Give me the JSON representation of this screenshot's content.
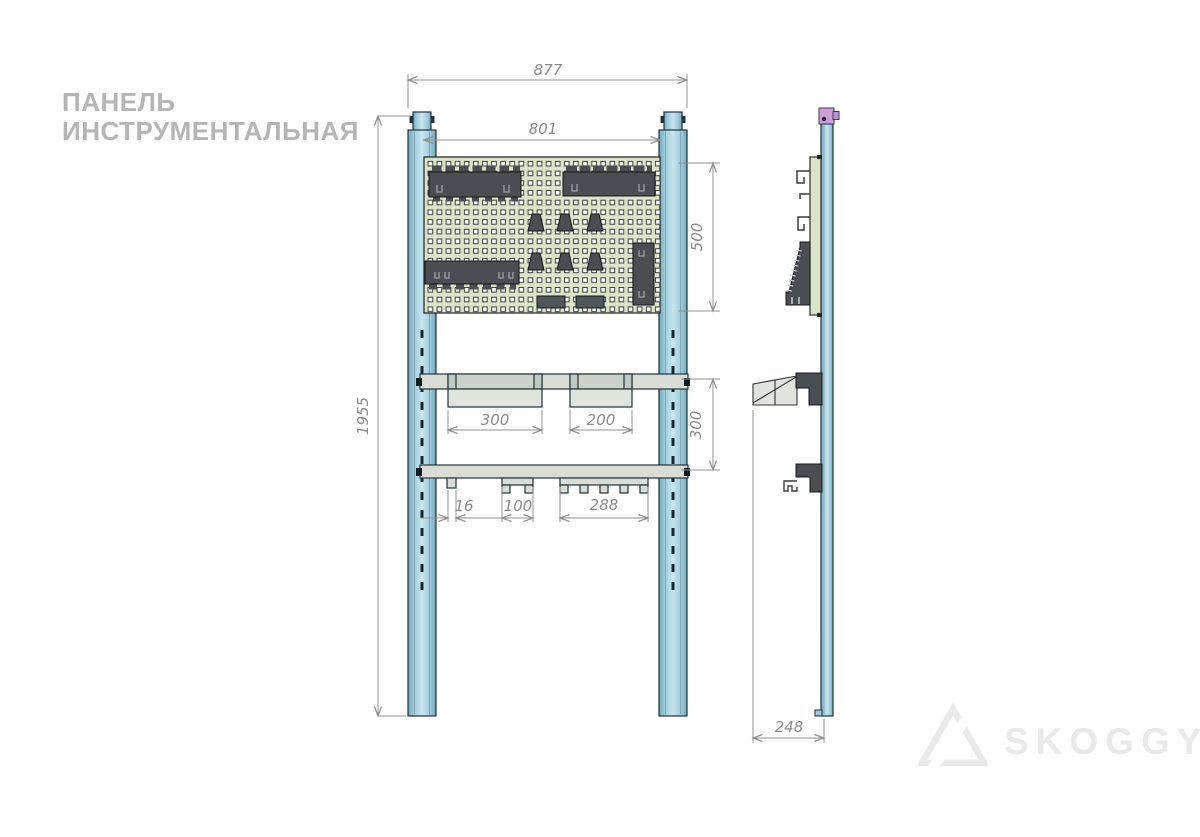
{
  "title": {
    "line1": "ПАНЕЛЬ",
    "line2": "ИНСТРУМЕНТАЛЬНАЯ"
  },
  "brand": {
    "name": "SKOGGY"
  },
  "drawing": {
    "type": "technical drawing — tool panel, front view and side view",
    "views": {
      "front": {
        "dims": {
          "overall_width": "877",
          "panel_width": "801",
          "panel_height": "500",
          "overall_height": "1955",
          "bin_large_width": "300",
          "bin_small_width": "200",
          "rail_spacing": "300",
          "hook_width": "16",
          "bracket_medium_width": "100",
          "bracket_wide_width": "288"
        }
      },
      "side": {
        "dims": {
          "depth": "248"
        }
      }
    },
    "colors": {
      "post_blue": "#a7cfdc",
      "panel_green": "#dbe3c9",
      "holder_gray": "#4a4e52",
      "rail_gray": "#d9ddd6",
      "cap_violet": "#c9a0d8",
      "dim_gray": "#8a8a8a"
    }
  }
}
